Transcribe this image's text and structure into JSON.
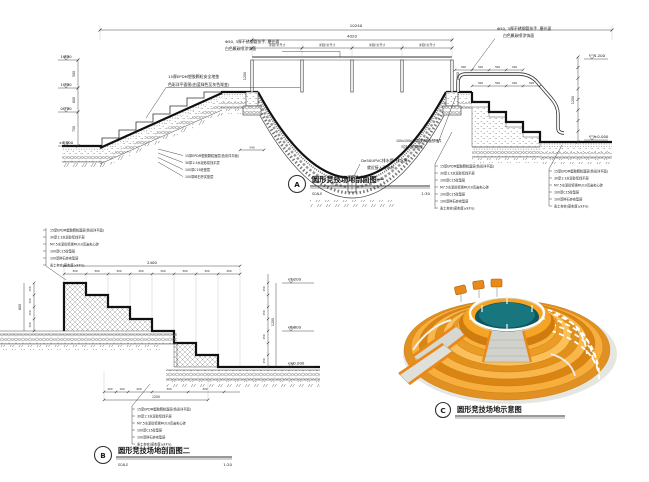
{
  "sheet": {
    "bg": "#ffffff"
  },
  "common": {
    "scale_word": "SCALE"
  },
  "a": {
    "tag": "A",
    "title": "圆形竞技场地剖面图一",
    "scale": "1:30",
    "dim_overall": "10240",
    "dim_rail": "4020",
    "rail_note": "详见栏杆尺寸",
    "dim_post": "1200",
    "dim_right": "1200",
    "dim_footing": "540",
    "step_dim": "300",
    "elev_left": [
      "1.850",
      "1.350",
      "0.750",
      "±0.000"
    ],
    "seg_left": [
      "500",
      "600",
      "750"
    ],
    "elev_right": [
      "1.200",
      "±0.000"
    ],
    "label_epdm": [
      "15厚EPDM塑胶颗粒安全地垫",
      "色彩详平面图(由蓝绿色至灰色渐变)"
    ],
    "label_rail": [
      "Φ50, 3厚不锈钢管扶手, 磨光面",
      "白色氟碳喷涂饰面"
    ],
    "label_drain": [
      "De50UPVC排水管, 排水箅",
      "就近接入雨水井"
    ],
    "label_plate": [
      "100x100x10厚镀锌钢板预埋件",
      "与扶手焊接固定"
    ],
    "layers_toe": [
      "15厚EPDM塑胶颗粒面层(色彩详平面)",
      "30厚1:3水泥砂浆找平层",
      "100厚C15砼垫层",
      "100厚碎石夯实垫层"
    ],
    "layers_r1": [
      "15厚EPDM塑胶颗粒面层(色彩详平面)",
      "30厚1:3水泥砂浆找平层",
      "100厚C15砼垫层",
      "M7.5水泥砂浆砌MU10页岩实心砖",
      "100厚C15砼垫层",
      "100厚碎石夯实垫层",
      "素土夯实(密实度≥93%)"
    ],
    "layers_r2": [
      "15厚EPDM塑胶颗粒面层(色彩详平面)",
      "30厚1:3水泥砂浆找平层",
      "M7.5水泥砂浆砌MU10页岩实心砖",
      "100厚C15砼垫层",
      "100厚碎石夯实垫层",
      "素土夯实(密实度≥93%)"
    ]
  },
  "b": {
    "tag": "B",
    "title": "圆形竞技场地剖面图二",
    "scale": "1:20",
    "dim_overall": "2400",
    "step_dim": "300",
    "rise_dim": "150",
    "seg_total_left": "600",
    "dim_right_total": "1200",
    "elev": [
      "1.200",
      "0.600",
      "±0.000"
    ],
    "dims_bottom": [
      "100",
      "100",
      "200",
      "300",
      "300"
    ],
    "dim_bottom_total": "1200",
    "layers_top": [
      "15厚EPDM塑胶颗粒面层(色彩详平面)",
      "30厚1:3水泥砂浆找平层",
      "M7.5水泥砂浆砌MU10页岩实心砖",
      "100厚C15砼垫层",
      "100厚碎石夯实垫层",
      "素土夯实(密实度≥93%)"
    ],
    "layers_bottom": [
      "15厚EPDM塑胶颗粒面层(色彩详平面)",
      "30厚1:3水泥砂浆找平层",
      "M7.5水泥砂浆砌MU10页岩实心砖",
      "100厚C15砼垫层",
      "100厚碎石夯实垫层",
      "素土夯实(密实度≥93%)"
    ]
  },
  "c": {
    "tag": "C",
    "title": "圆形竞技场地示意图",
    "colors": {
      "terrace_orange": "#ef9c22",
      "terrace_light": "#f9b64a",
      "terrace_dark": "#d98a1f",
      "pit_teal": "#156a72",
      "rail_white": "#ffffff",
      "ramp_gray": "#d8d8d2"
    }
  }
}
